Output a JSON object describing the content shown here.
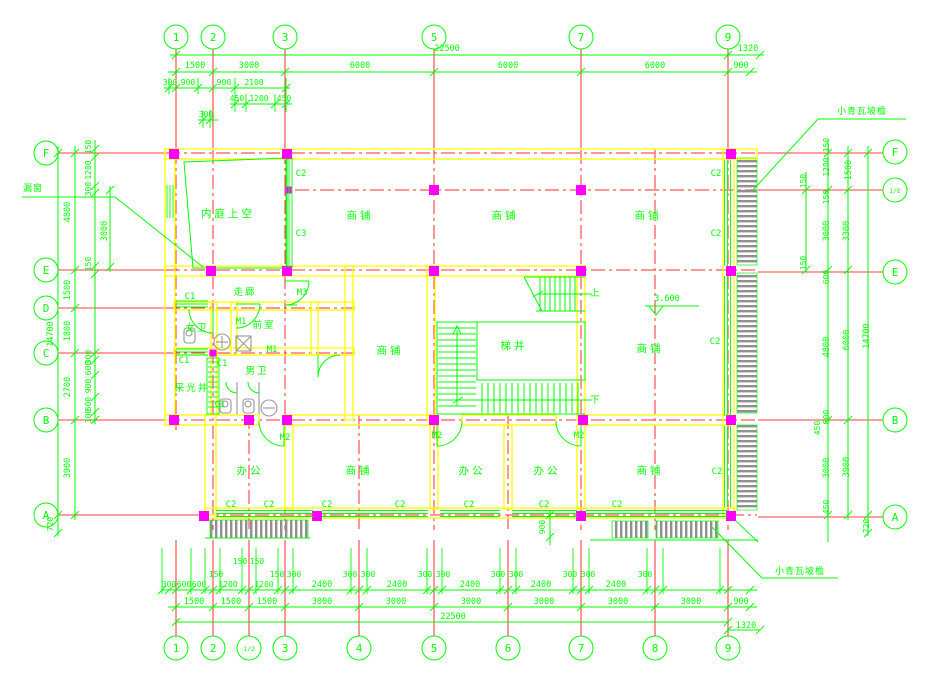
{
  "drawing": {
    "grid": {
      "top": [
        "1",
        "2",
        "3",
        "5",
        "7",
        "9"
      ],
      "bottom": [
        "1",
        "2",
        "1/2",
        "3",
        "4",
        "5",
        "6",
        "7",
        "8",
        "9"
      ],
      "left": [
        "F",
        "E",
        "D",
        "C",
        "B",
        "A"
      ],
      "right": [
        "F",
        "1/E",
        "E",
        "B",
        "A"
      ]
    },
    "rooms": {
      "courtyard": "内庭上空",
      "shop": "商铺",
      "corridor": "走廊",
      "anteroom": "前室",
      "womens_wc": "女卫",
      "mens_wc": "男卫",
      "light_well": "采光井",
      "stair_well": "梯井",
      "office": "办公"
    },
    "tags": {
      "c1": "C1",
      "c2": "C2",
      "c3": "C3",
      "m1": "M1",
      "m2": "M2",
      "m3": "M3"
    },
    "labels": {
      "eave": "小青瓦坡檐",
      "lattice_window": "漏窗",
      "elevation": "3.600",
      "up": "上",
      "down": "下"
    },
    "dims": {
      "top": {
        "row_overall": [
          "22500",
          "1320"
        ],
        "row_main": [
          "1500",
          "3000",
          "6000",
          "6000",
          "6000",
          "900"
        ],
        "row_sub1": [
          "300",
          "900",
          "900",
          "2100"
        ],
        "row_sub2": [
          "450",
          "1200",
          "450"
        ],
        "row_sub3": [
          "300"
        ]
      },
      "bottom": {
        "row_tier3": [
          "150",
          "150"
        ],
        "row_tier2": [
          "150",
          "150",
          "300",
          "300",
          "300",
          "300",
          "300",
          "300",
          "300",
          "300",
          "300",
          "300"
        ],
        "row_sub": [
          "300",
          "600",
          "600",
          "1200",
          "1200",
          "2400",
          "2400",
          "2400",
          "2400",
          "2400"
        ],
        "row_main": [
          "1500",
          "1500",
          "1500",
          "3000",
          "3000",
          "3000",
          "3000",
          "3000",
          "3000",
          "900"
        ],
        "row_overall": [
          "22500",
          "1320"
        ],
        "eave_depth": "900"
      },
      "left": {
        "outer": [
          "14700",
          "720"
        ],
        "main": [
          "4800",
          "1500",
          "1800",
          "2700",
          "3900"
        ],
        "sub": [
          "150",
          "1200",
          "300",
          "3000",
          "150",
          "300",
          "600",
          "900",
          "600",
          "300"
        ]
      },
      "right": {
        "outer": [
          "14700",
          "720"
        ],
        "col3": [
          "1500",
          "3300",
          "6000",
          "3900"
        ],
        "col2": [
          "150",
          "1200",
          "150",
          "3000",
          "600",
          "4800",
          "600",
          "450",
          "3000",
          "450"
        ],
        "col1": [
          "150",
          "150"
        ]
      }
    },
    "colors": {
      "line_green": "#00ff00",
      "axis_red": "#ff2b2b",
      "wall_yellow": "#ffff00",
      "column_magenta": "#ff00ff",
      "fixture_grey": "#989898",
      "background": "#ffffff"
    }
  }
}
